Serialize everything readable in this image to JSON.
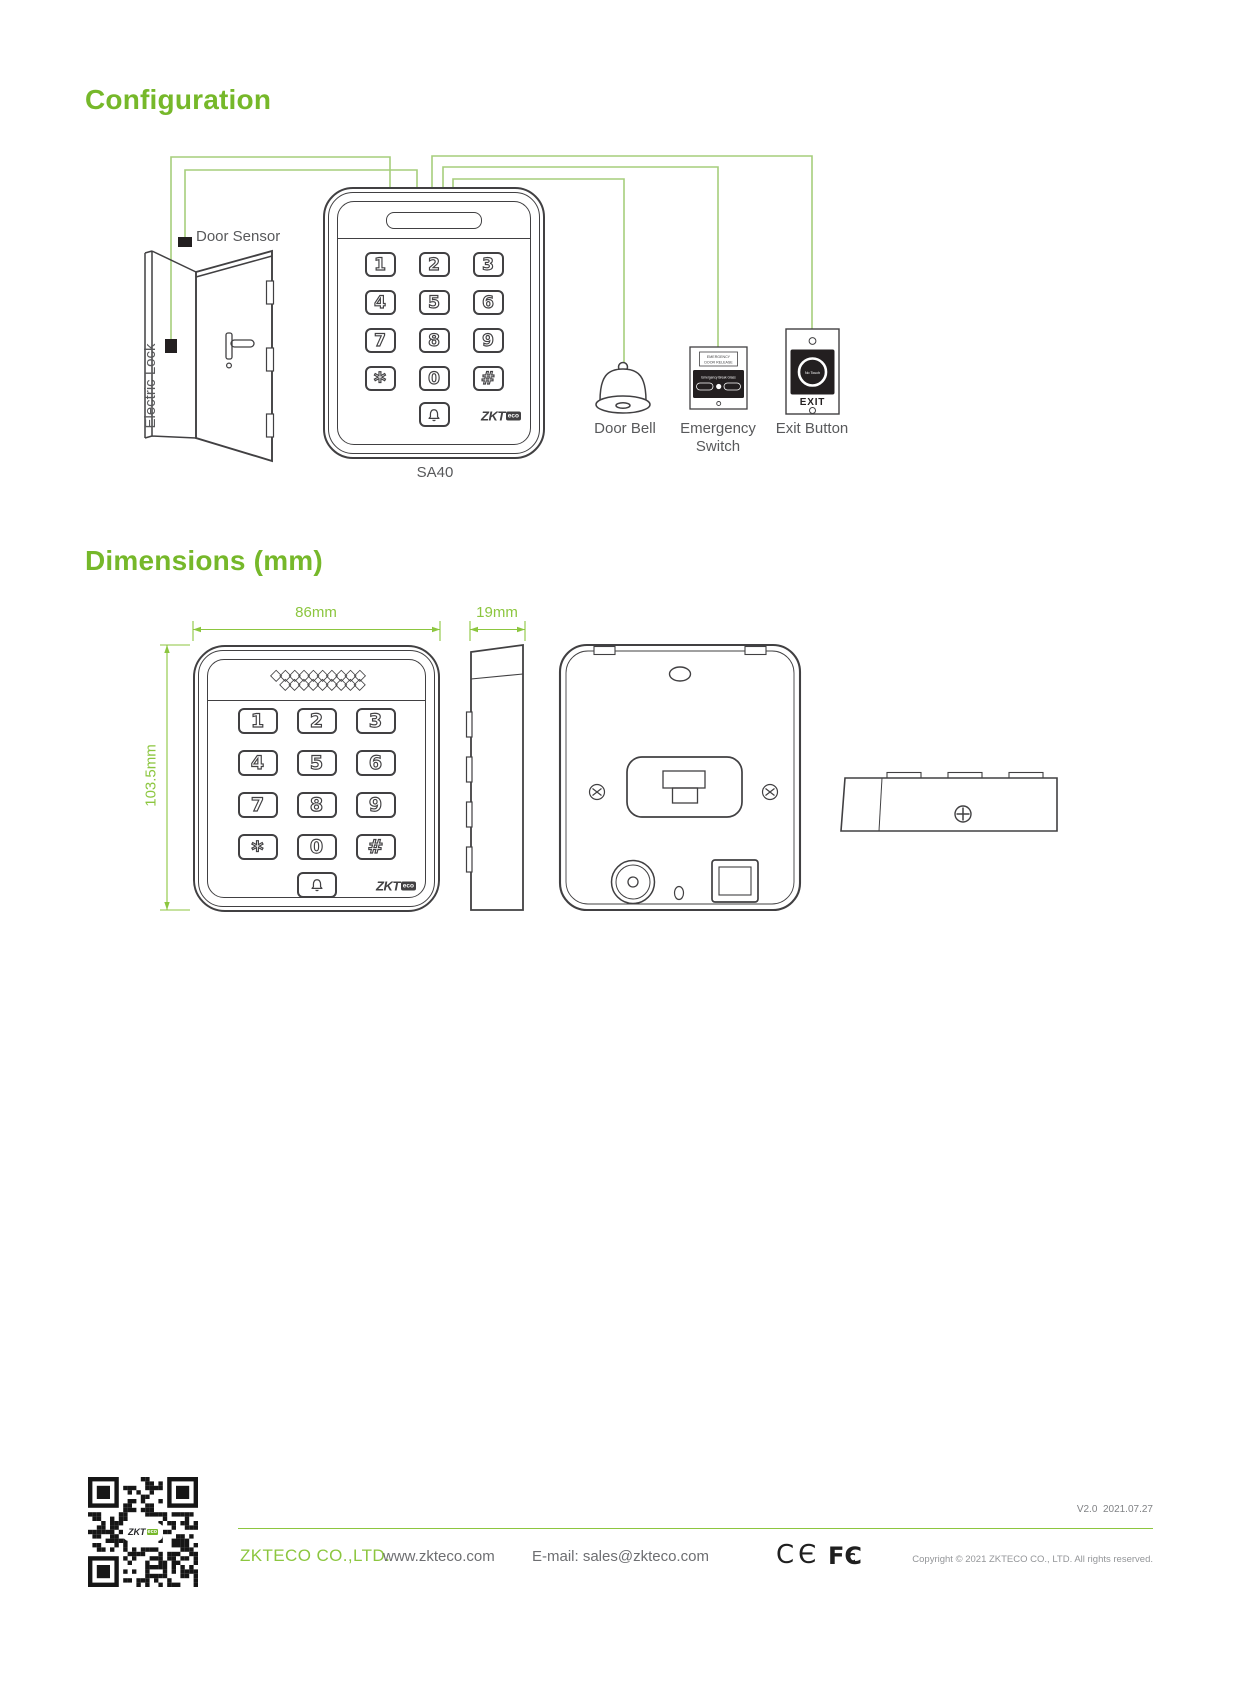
{
  "colors": {
    "brand_green": "#76b82a",
    "dim_green": "#8cc63f",
    "wire_green": "#a6ce7c",
    "line_ink": "#414042",
    "label_gray": "#58595b",
    "footer_gray": "#808285"
  },
  "sections": {
    "configuration_title": "Configuration",
    "dimensions_title": "Dimensions (mm)"
  },
  "configuration": {
    "door_sensor_label": "Door Sensor",
    "electric_lock_label": "Electric Lock",
    "device_model_label": "SA40",
    "door_bell_label": "Door Bell",
    "emergency_switch_label_line1": "Emergency",
    "emergency_switch_label_line2": "Switch",
    "exit_button_label": "Exit Button",
    "emergency_device": {
      "header_line1": "EMERGENCY",
      "header_line2": "DOOR RELEASE",
      "panel_text": "Emergency Break Glass"
    },
    "exit_device": {
      "button_text": "No Touch",
      "label": "EXIT"
    }
  },
  "brand": {
    "zkt": "ZKT",
    "eco": "eco"
  },
  "keypad": {
    "keys_rows": [
      [
        "1",
        "2",
        "3"
      ],
      [
        "4",
        "5",
        "6"
      ],
      [
        "7",
        "8",
        "9"
      ],
      [
        "*",
        "0",
        "#"
      ]
    ]
  },
  "dimensions": {
    "width_label": "86mm",
    "depth_label": "19mm",
    "height_label": "103.5mm"
  },
  "footer": {
    "version": "V2.0  2021.07.27",
    "company": "ZKTECO CO.,LTD.",
    "website": "www.zkteco.com",
    "email": "E-mail: sales@zkteco.com",
    "copyright": "Copyright © 2021 ZKTECO CO., LTD. All rights reserved.",
    "ce_mark": "CЄ",
    "fcc_outer": "FC",
    "fcc_inner": "C"
  }
}
